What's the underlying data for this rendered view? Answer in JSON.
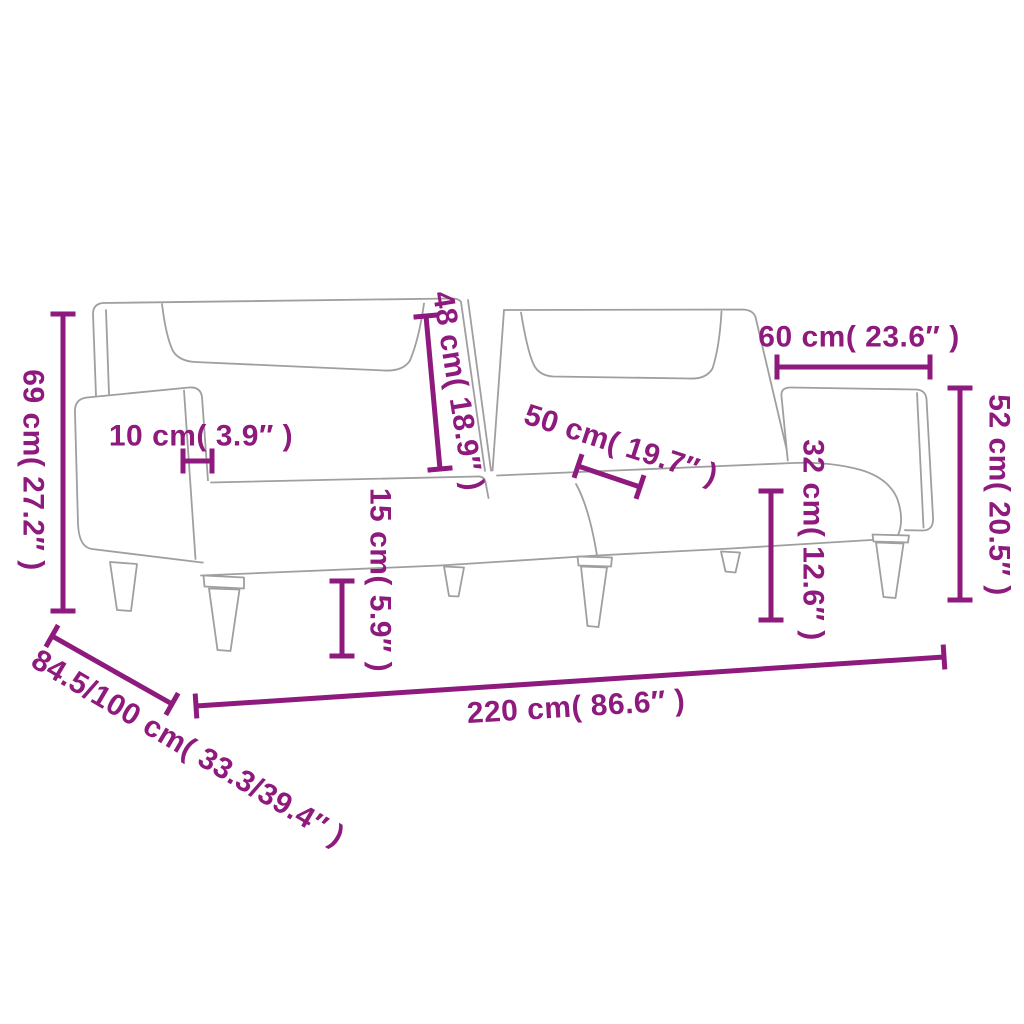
{
  "page": {
    "width": 1024,
    "height": 1024,
    "background": "#ffffff"
  },
  "diagram": {
    "title": "Sofa bed dimension diagram",
    "subject": "two-seater sofa bed line drawing with measurement callouts",
    "accent_color": "#8e1a7d",
    "outline_color": "#9f9f9f",
    "style": {
      "line_width": 5,
      "cap_half_length": 12.5,
      "font_size": 30
    },
    "dimensions": [
      {
        "id": "overall-height-69cm",
        "value_cm": "69",
        "value_in": "27.2",
        "label": "69 cm( 27.2″ )",
        "line": {
          "x1": 63,
          "y1": 314,
          "x2": 63,
          "y2": 611
        },
        "label_pos": {
          "x": 33,
          "y": 470,
          "rotate": 90
        }
      },
      {
        "id": "armrest-width-10cm",
        "value_cm": "10",
        "value_in": "3.9",
        "label": "10 cm( 3.9″ )",
        "line": {
          "x1": 183,
          "y1": 461,
          "x2": 212,
          "y2": 461
        },
        "label_pos": {
          "x": 201,
          "y": 436,
          "rotate": 0
        }
      },
      {
        "id": "backrest-height-48cm",
        "value_cm": "48",
        "value_in": "18.9",
        "label": "48 cm( 18.9″ )",
        "line": {
          "x1": 426,
          "y1": 316,
          "x2": 440,
          "y2": 469
        },
        "label_pos": {
          "x": 458,
          "y": 391,
          "rotate": 81
        }
      },
      {
        "id": "seat-depth-50cm",
        "value_cm": "50",
        "value_in": "19.7",
        "label": "50 cm( 19.7″ )",
        "line": {
          "x1": 578,
          "y1": 466,
          "x2": 640,
          "y2": 487
        },
        "label_pos": {
          "x": 621,
          "y": 445,
          "rotate": 18
        }
      },
      {
        "id": "section-width-60cm",
        "value_cm": "60",
        "value_in": "23.6",
        "label": "60 cm( 23.6″ )",
        "line": {
          "x1": 777,
          "y1": 367,
          "x2": 930,
          "y2": 367
        },
        "label_pos": {
          "x": 859,
          "y": 337,
          "rotate": 0
        }
      },
      {
        "id": "right-height-52cm",
        "value_cm": "52",
        "value_in": "20.5",
        "label": "52 cm( 20.5″ )",
        "line": {
          "x1": 960,
          "y1": 388,
          "x2": 960,
          "y2": 600
        },
        "label_pos": {
          "x": 999,
          "y": 495,
          "rotate": 90
        }
      },
      {
        "id": "seat-height-32cm",
        "value_cm": "32",
        "value_in": "12.6",
        "label": "32 cm( 12.6″ )",
        "line": {
          "x1": 771,
          "y1": 491,
          "x2": 771,
          "y2": 620
        },
        "label_pos": {
          "x": 813,
          "y": 540,
          "rotate": 90
        }
      },
      {
        "id": "leg-height-15cm",
        "value_cm": "15",
        "value_in": "5.9",
        "label": "15 cm( 5.9″ )",
        "line": {
          "x1": 342,
          "y1": 581,
          "x2": 342,
          "y2": 656
        },
        "label_pos": {
          "x": 380,
          "y": 580,
          "rotate": 90
        }
      },
      {
        "id": "overall-width-220cm",
        "value_cm": "220",
        "value_in": "86.6",
        "label": "220 cm( 86.6″ )",
        "line": {
          "x1": 196,
          "y1": 706,
          "x2": 944,
          "y2": 657
        },
        "label_pos": {
          "x": 576,
          "y": 707,
          "rotate": -3.5
        }
      },
      {
        "id": "depth-845-100cm",
        "value_cm": "84.5/100",
        "value_in": "33.3/39.4",
        "label": "84.5/100 cm( 33.3/39.4″ )",
        "line": {
          "x1": 52,
          "y1": 636,
          "x2": 172,
          "y2": 704
        },
        "label_pos": {
          "x": 188,
          "y": 748,
          "rotate": 30.5
        }
      }
    ]
  }
}
